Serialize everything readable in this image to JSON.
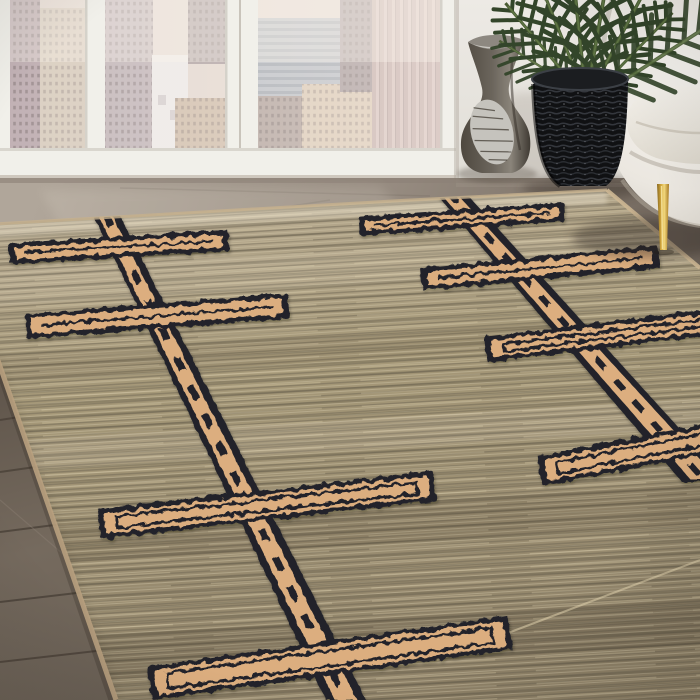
{
  "meta": {
    "type": "product-photograph",
    "subject": "Hand-woven jute area rug with tribal cross motifs staged in a city-view living room",
    "alt": "Natural beige jute flatweave rug with raised camel and black linked-cross ladder motifs, laid on a grey-brown wood floor in front of floor-to-ceiling windows overlooking a hazy city skyline; a cream boucle armchair with a gold tapered leg, a black coiled woven planter holding a palm, and a dark sculptural vase stand behind the rug"
  },
  "palette": {
    "wall": "#eae7e2",
    "window_frame": "#f1f0ea",
    "city_haze": "#e3d6cd",
    "floor_taupe_light": "#b0a69a",
    "floor_taupe_dark": "#6e645a",
    "wood_plank": "#6b5f53",
    "wood_seam": "#4a4138",
    "rug_field": "#a29478",
    "rug_field_light": "#cfc3a6",
    "rug_field_dark": "#6d6553",
    "motif_camel": "#dcae7f",
    "motif_camel_light": "#ecd0a6",
    "motif_black": "#22242a",
    "rug_binding": "#c6b08d",
    "chair_cream": "#f0ede7",
    "chair_shadow": "#d6d1c8",
    "gold_leg": "#d4a93f",
    "basket_black": "#131416",
    "leaf_green": "#33452a",
    "leaf_rib": "#5f7645",
    "vase_body": "#5f584e",
    "vase_highlight": "#c5c3bd"
  },
  "scene": {
    "window": {
      "label": "floor-to-ceiling window wall with city skyline",
      "pane_count": 4
    },
    "objects": [
      {
        "name": "sculptural-vase",
        "desc": "dark pewter curved vase with silver textured patch"
      },
      {
        "name": "woven-planter",
        "desc": "black coiled wicker basket planter"
      },
      {
        "name": "palm-plant",
        "desc": "areca palm fronds fanning above planter"
      },
      {
        "name": "armchair",
        "desc": "cream boucle armchair with tapered gold metal leg"
      },
      {
        "name": "wood-floor",
        "desc": "grey-brown plank flooring at lower left"
      }
    ],
    "rug": {
      "desc": "flatweave jute field with high-pile linked cross (double-cross ladder) motifs in two diagonal chains",
      "chains": [
        {
          "outer": "92,212 118,212 366,700 326,700",
          "inner": "98,215 112,215 357,700 335,700",
          "dash": [
            105,
            214,
            346,
            700
          ],
          "dash_w": 7,
          "dash_array": "14 18"
        },
        {
          "outer": "433,190 463,190 728,482 682,482",
          "inner": "440,193 456,193 719,480 691,480",
          "dash": [
            448,
            192,
            705,
            481
          ],
          "dash_w": 6,
          "dash_array": "12 16"
        }
      ],
      "crosses": [
        {
          "cx": 119,
          "cy": 247,
          "hl": 110,
          "th": 21,
          "rot": -3.5
        },
        {
          "cx": 157,
          "cy": 316,
          "hl": 132,
          "th": 25,
          "rot": -4.5
        },
        {
          "cx": 267,
          "cy": 505,
          "hl": 169,
          "th": 30,
          "rot": -6.5
        },
        {
          "cx": 330,
          "cy": 658,
          "hl": 182,
          "th": 34,
          "rot": -8
        },
        {
          "cx": 462,
          "cy": 219,
          "hl": 103,
          "th": 19,
          "rot": -4
        },
        {
          "cx": 540,
          "cy": 268,
          "hl": 119,
          "th": 23,
          "rot": -5.5
        },
        {
          "cx": 622,
          "cy": 333,
          "hl": 137,
          "th": 26,
          "rot": -7
        },
        {
          "cx": 685,
          "cy": 443,
          "hl": 148,
          "th": 30,
          "rot": -11
        }
      ]
    }
  }
}
